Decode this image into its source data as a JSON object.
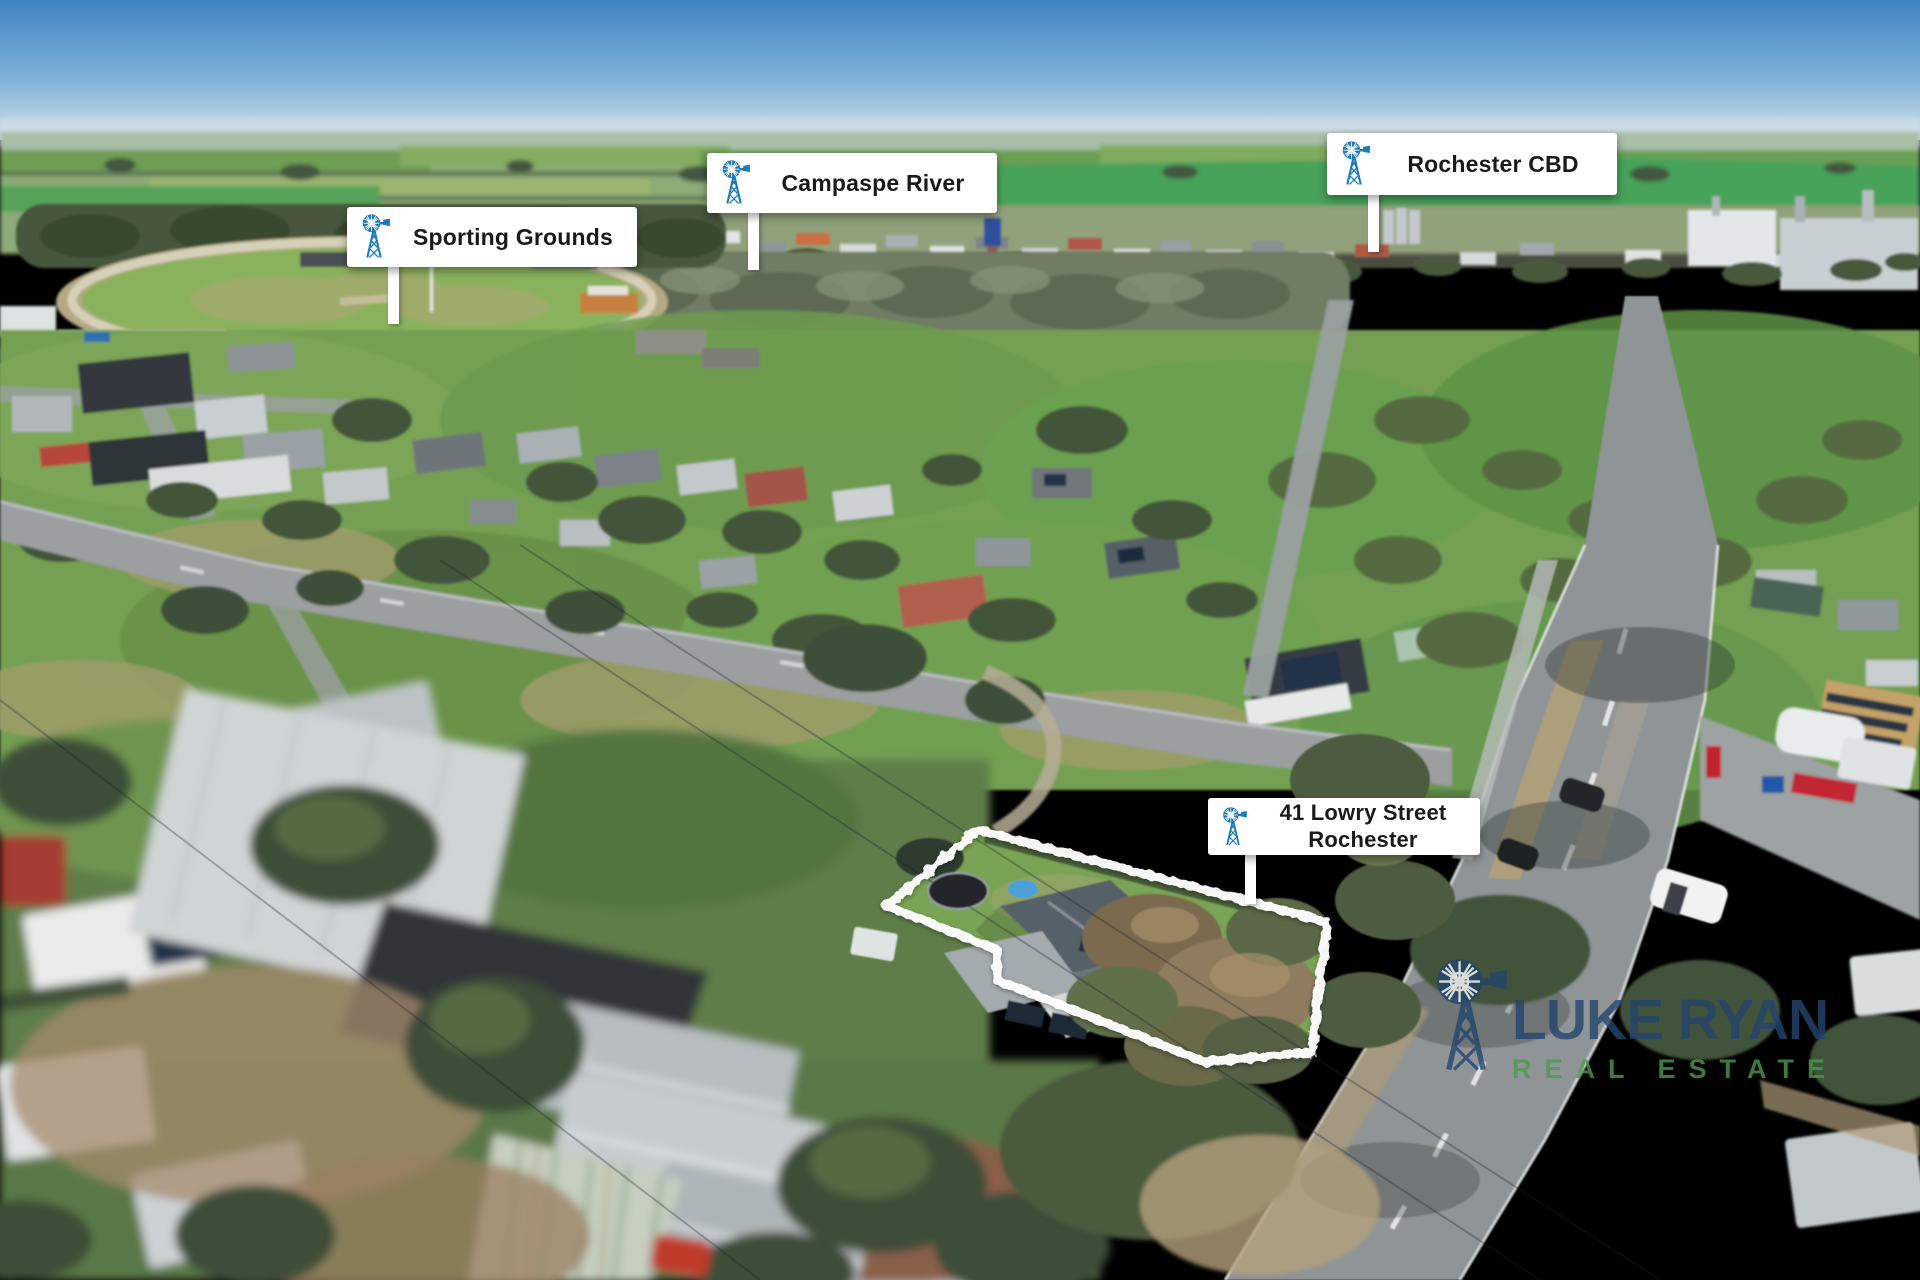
{
  "annotations": {
    "sporting_grounds": {
      "label": "Sporting Grounds"
    },
    "campaspe_river": {
      "label": "Campaspe River"
    },
    "rochester_cbd": {
      "label": "Rochester CBD"
    },
    "property": {
      "line1": "41 Lowry Street",
      "line2": "Rochester"
    }
  },
  "watermark": {
    "brand": "LUKE RYAN",
    "tagline": "REAL ESTATE"
  },
  "colors": {
    "label_background": "#ffffff",
    "label_text": "#1a1a1a",
    "windmill_blue": "#1b7ab8",
    "watermark_navy": "#24456e",
    "watermark_green": "#4b9a4d",
    "boundary": "#ffffff"
  }
}
